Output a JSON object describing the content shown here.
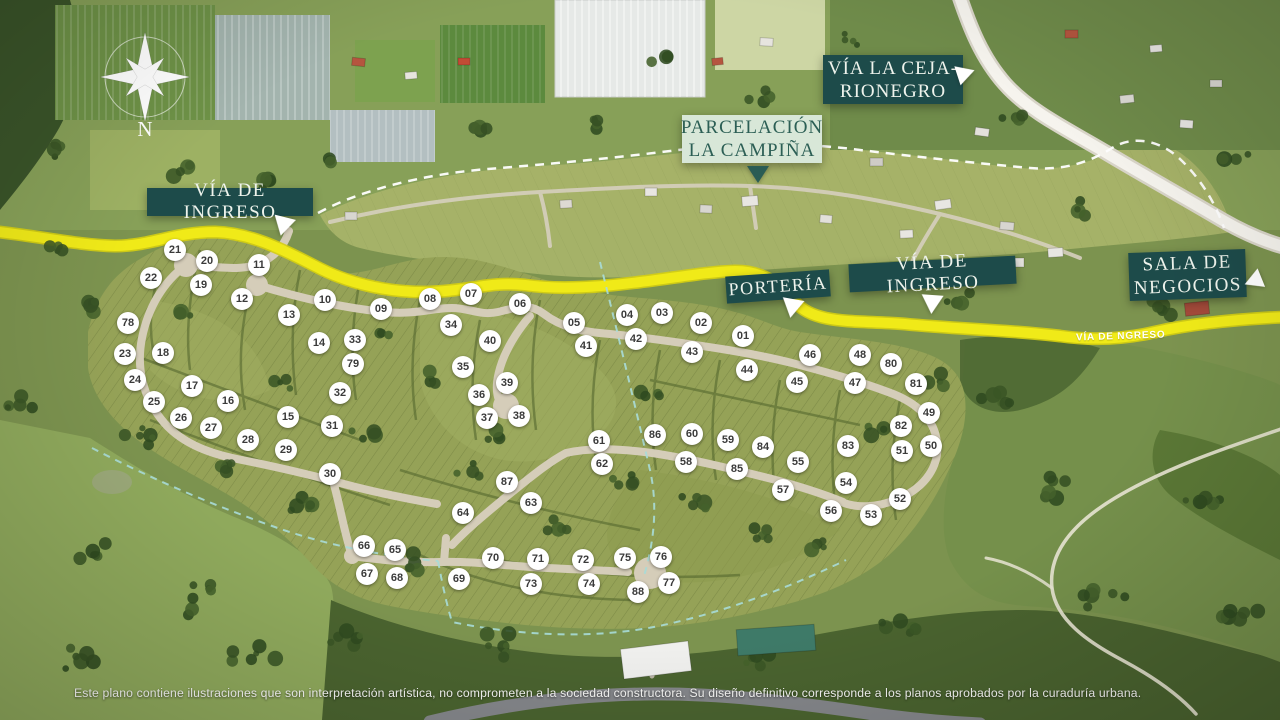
{
  "labels": {
    "via_de_ingreso_top": "VÍA DE INGRESO",
    "parcelacion": {
      "line1": "PARCELACIÓN",
      "line2": "LA CAMPIÑA"
    },
    "via_la_ceja": {
      "line1": "VÍA LA CEJA-",
      "line2": "RIONEGRO"
    },
    "porteria": "PORTERÍA",
    "via_de_ingreso_mid": "VÍA DE INGRESO",
    "sala_de_negocios": {
      "line1": "SALA DE",
      "line2": "NEGOCIOS"
    },
    "road_small_label": "VÍA DE NGRESO",
    "compass_letter": "N"
  },
  "disclaimer": "Este plano contiene ilustraciones que son interpretación artística, no comprometen a la sociedad constructora. Su diseño definitivo corresponde a los planos aprobados por la curaduría urbana.",
  "colors": {
    "label_teal_bg": "#1d4b4a",
    "label_mint_bg": "#d8e7d8",
    "label_mint_text": "#2c5f55",
    "road_yellow": "#f0ea18",
    "lot_circle_bg": "#ffffff",
    "lot_circle_text": "#3a3a3a",
    "boundary_dash_white": "#ffffff",
    "boundary_dash_teal": "#a8dcd8"
  },
  "lots": [
    {
      "n": "01",
      "x": 743,
      "y": 336
    },
    {
      "n": "02",
      "x": 701,
      "y": 323
    },
    {
      "n": "03",
      "x": 662,
      "y": 313
    },
    {
      "n": "04",
      "x": 627,
      "y": 315
    },
    {
      "n": "05",
      "x": 574,
      "y": 323
    },
    {
      "n": "06",
      "x": 520,
      "y": 304
    },
    {
      "n": "07",
      "x": 471,
      "y": 294
    },
    {
      "n": "08",
      "x": 430,
      "y": 299
    },
    {
      "n": "09",
      "x": 381,
      "y": 309
    },
    {
      "n": "10",
      "x": 325,
      "y": 300
    },
    {
      "n": "11",
      "x": 259,
      "y": 265
    },
    {
      "n": "12",
      "x": 242,
      "y": 299
    },
    {
      "n": "13",
      "x": 289,
      "y": 315
    },
    {
      "n": "14",
      "x": 319,
      "y": 343
    },
    {
      "n": "15",
      "x": 288,
      "y": 417
    },
    {
      "n": "16",
      "x": 228,
      "y": 401
    },
    {
      "n": "17",
      "x": 192,
      "y": 386
    },
    {
      "n": "18",
      "x": 163,
      "y": 353
    },
    {
      "n": "19",
      "x": 201,
      "y": 285
    },
    {
      "n": "20",
      "x": 207,
      "y": 261
    },
    {
      "n": "21",
      "x": 175,
      "y": 250
    },
    {
      "n": "22",
      "x": 151,
      "y": 278
    },
    {
      "n": "23",
      "x": 125,
      "y": 354
    },
    {
      "n": "24",
      "x": 135,
      "y": 380
    },
    {
      "n": "25",
      "x": 154,
      "y": 402
    },
    {
      "n": "26",
      "x": 181,
      "y": 418
    },
    {
      "n": "27",
      "x": 211,
      "y": 428
    },
    {
      "n": "28",
      "x": 248,
      "y": 440
    },
    {
      "n": "29",
      "x": 286,
      "y": 450
    },
    {
      "n": "30",
      "x": 330,
      "y": 474
    },
    {
      "n": "31",
      "x": 332,
      "y": 426
    },
    {
      "n": "32",
      "x": 340,
      "y": 393
    },
    {
      "n": "33",
      "x": 355,
      "y": 340
    },
    {
      "n": "34",
      "x": 451,
      "y": 325
    },
    {
      "n": "35",
      "x": 463,
      "y": 367
    },
    {
      "n": "36",
      "x": 479,
      "y": 395
    },
    {
      "n": "37",
      "x": 487,
      "y": 418
    },
    {
      "n": "38",
      "x": 519,
      "y": 416
    },
    {
      "n": "39",
      "x": 507,
      "y": 383
    },
    {
      "n": "40",
      "x": 490,
      "y": 341
    },
    {
      "n": "41",
      "x": 586,
      "y": 346
    },
    {
      "n": "42",
      "x": 636,
      "y": 339
    },
    {
      "n": "43",
      "x": 692,
      "y": 352
    },
    {
      "n": "44",
      "x": 747,
      "y": 370
    },
    {
      "n": "45",
      "x": 797,
      "y": 382
    },
    {
      "n": "46",
      "x": 810,
      "y": 355
    },
    {
      "n": "47",
      "x": 855,
      "y": 383
    },
    {
      "n": "48",
      "x": 860,
      "y": 355
    },
    {
      "n": "49",
      "x": 929,
      "y": 413
    },
    {
      "n": "50",
      "x": 931,
      "y": 446
    },
    {
      "n": "51",
      "x": 902,
      "y": 451
    },
    {
      "n": "52",
      "x": 900,
      "y": 499
    },
    {
      "n": "53",
      "x": 871,
      "y": 515
    },
    {
      "n": "54",
      "x": 846,
      "y": 483
    },
    {
      "n": "55",
      "x": 798,
      "y": 462
    },
    {
      "n": "56",
      "x": 831,
      "y": 511
    },
    {
      "n": "57",
      "x": 783,
      "y": 490
    },
    {
      "n": "58",
      "x": 686,
      "y": 462
    },
    {
      "n": "59",
      "x": 728,
      "y": 440
    },
    {
      "n": "60",
      "x": 692,
      "y": 434
    },
    {
      "n": "61",
      "x": 599,
      "y": 441
    },
    {
      "n": "62",
      "x": 602,
      "y": 464
    },
    {
      "n": "63",
      "x": 531,
      "y": 503
    },
    {
      "n": "64",
      "x": 463,
      "y": 513
    },
    {
      "n": "65",
      "x": 395,
      "y": 550
    },
    {
      "n": "66",
      "x": 364,
      "y": 546
    },
    {
      "n": "67",
      "x": 367,
      "y": 574
    },
    {
      "n": "68",
      "x": 397,
      "y": 578
    },
    {
      "n": "69",
      "x": 459,
      "y": 579
    },
    {
      "n": "70",
      "x": 493,
      "y": 558
    },
    {
      "n": "71",
      "x": 538,
      "y": 559
    },
    {
      "n": "72",
      "x": 583,
      "y": 560
    },
    {
      "n": "73",
      "x": 531,
      "y": 584
    },
    {
      "n": "74",
      "x": 589,
      "y": 584
    },
    {
      "n": "75",
      "x": 625,
      "y": 558
    },
    {
      "n": "76",
      "x": 661,
      "y": 557
    },
    {
      "n": "77",
      "x": 669,
      "y": 583
    },
    {
      "n": "78",
      "x": 128,
      "y": 323
    },
    {
      "n": "79",
      "x": 353,
      "y": 364
    },
    {
      "n": "80",
      "x": 891,
      "y": 364
    },
    {
      "n": "81",
      "x": 916,
      "y": 384
    },
    {
      "n": "82",
      "x": 901,
      "y": 426
    },
    {
      "n": "83",
      "x": 848,
      "y": 446
    },
    {
      "n": "84",
      "x": 763,
      "y": 447
    },
    {
      "n": "85",
      "x": 737,
      "y": 469
    },
    {
      "n": "86",
      "x": 655,
      "y": 435
    },
    {
      "n": "87",
      "x": 507,
      "y": 482
    },
    {
      "n": "88",
      "x": 638,
      "y": 592
    }
  ]
}
